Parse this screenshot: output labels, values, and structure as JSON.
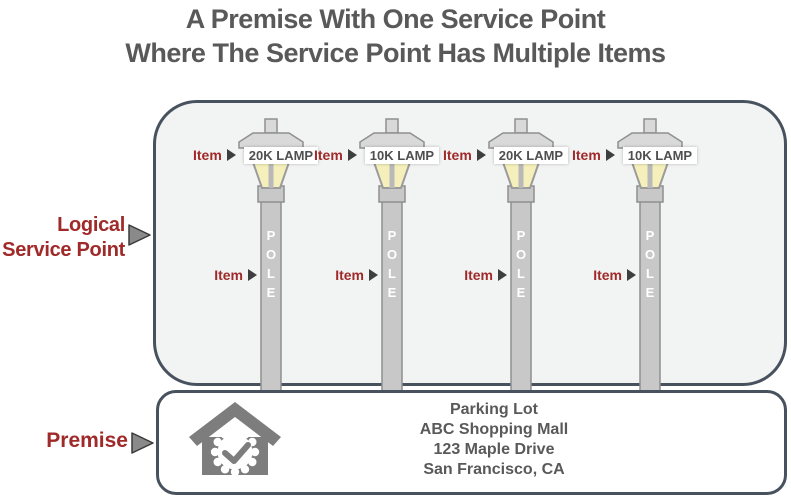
{
  "title": {
    "line1": "A Premise With One Service Point",
    "line2": "Where The Service Point Has Multiple Items"
  },
  "labels": {
    "logical_service_point_line1": "Logical",
    "logical_service_point_line2": "Service Point",
    "premise": "Premise",
    "item": "Item",
    "pole_vertical": "P\nO\nL\nE"
  },
  "lamps": [
    {
      "label": "20K LAMP"
    },
    {
      "label": "10K LAMP"
    },
    {
      "label": "20K LAMP"
    },
    {
      "label": "10K LAMP"
    }
  ],
  "premise": {
    "address_lines": [
      "Parking Lot",
      "ABC Shopping Mall",
      "123 Maple Drive",
      "San Francisco, CA"
    ]
  },
  "colors": {
    "accent_red": "#a02a2a",
    "box_border": "#47525e",
    "text_gray": "#595959",
    "lamp_glow": "#f5f0bb",
    "metal_gray": "#c8c8c8"
  }
}
